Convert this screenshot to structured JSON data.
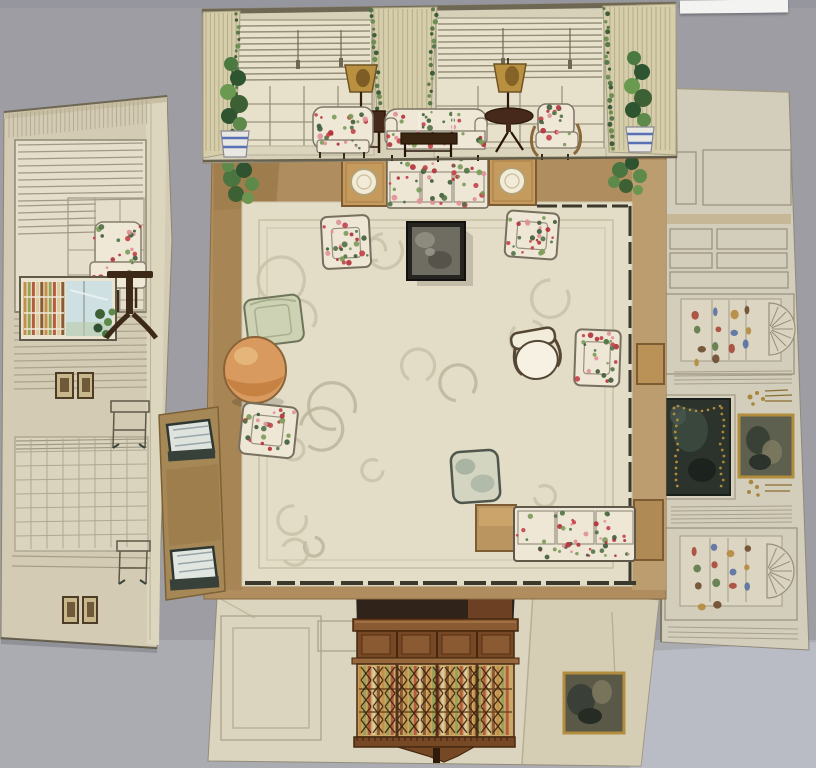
{
  "artwork": {
    "kind": "photograph of a watercolor fold-out interior design: floor plan of a living room with four wall elevations folded outward",
    "corner_label_text": "",
    "palette": {
      "backdrop": "#9d9da3",
      "backdrop_bottom": "#abacb2",
      "backdrop_bottom_right": "#b9bbc5",
      "label": "#f3f3f1",
      "paper_cream": "#d8d1ba",
      "paper_beige": "#d3cbb4",
      "drapery": "#d6cdaa",
      "window_cream": "#e7e1cc",
      "floor_tan": "#b08d5e",
      "flap_tan": "#a68756",
      "carpet": "#e3dcc6",
      "carpet_swirl": "#c7c0a7",
      "pencil": "#968f7c",
      "wood_dark": "#46291a",
      "wood_mahogany": "#7b4a26",
      "bookcase_plan_dark": "#30231a",
      "floral_ground": "#efe8d7",
      "floral_red": "#c24048",
      "floral_pink": "#e09098",
      "leaf_green": "#507246",
      "fireplace_dark": "#2b332c",
      "gilt_gold": "#b28d3e",
      "lamp_shade": "#b8903f",
      "bench_silver": "#dfe3de",
      "table_orange": "#d89a5e",
      "celadon": "#ccd2b3",
      "plant_pot_blue": "#5870b5"
    },
    "elements": [
      "top-wall-elevation: window wall with venetian blinds, three cream draperies, two potted vines in blue-banded pots, floral armchairs, floral sofa, dark coffee table, two table lamps with gold shades",
      "left-wall-elevation: two blinded windows, floral side chair, alcove with colored books and window view, dark pedestal table, two pairs of small framed pictures, pencil furniture sketches",
      "right-wall-elevation: pencil-drawn paneling, two shell-top china niches with small colored wares, dark marble fireplace with gilt garland, gilt-framed painting, gilt candle sconces",
      "bottom-wall-elevation: mahogany breakfront bookcase with fretwork glazed doors over colored book spines, gilt-framed dark painting, pencil panel outlines",
      "floor-plan: cream scroll-patterned carpet with tan wood border, plan views of floral sofas, floral armchairs, celadon chair, round orange table, dark marble-top center table, end tables with lamps, corner plants, white desk chair, two silver window benches on side flap"
    ]
  }
}
